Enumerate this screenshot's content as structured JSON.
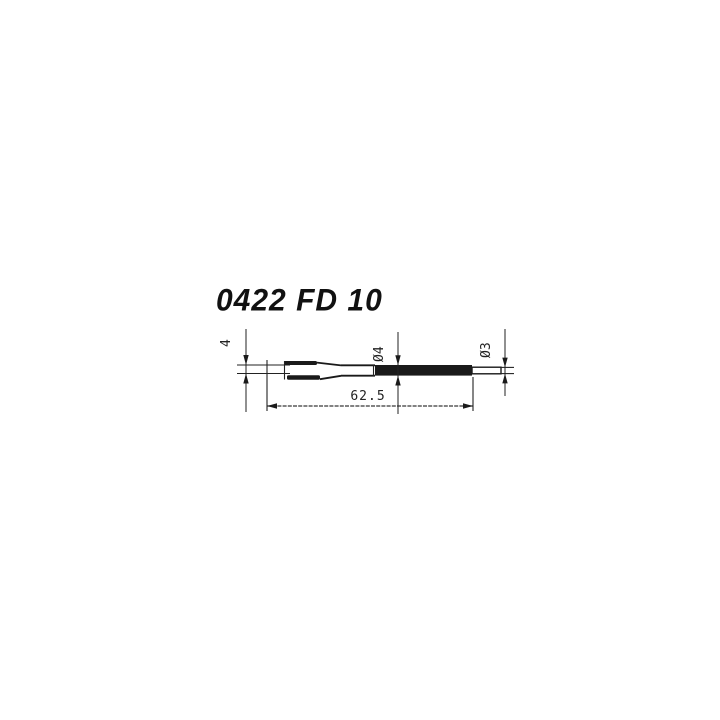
{
  "title": "0422 FD 10",
  "drawing": {
    "dimensions": {
      "tip_width": {
        "label": "4"
      },
      "shaft_diameter": {
        "label": "Ø4"
      },
      "end_diameter": {
        "label": "Ø3"
      },
      "overall_length": {
        "label": "62.5"
      }
    },
    "colors": {
      "background": "#ffffff",
      "line": "#222222",
      "ink": "#1a1a1a",
      "title_color": "#111111"
    }
  }
}
